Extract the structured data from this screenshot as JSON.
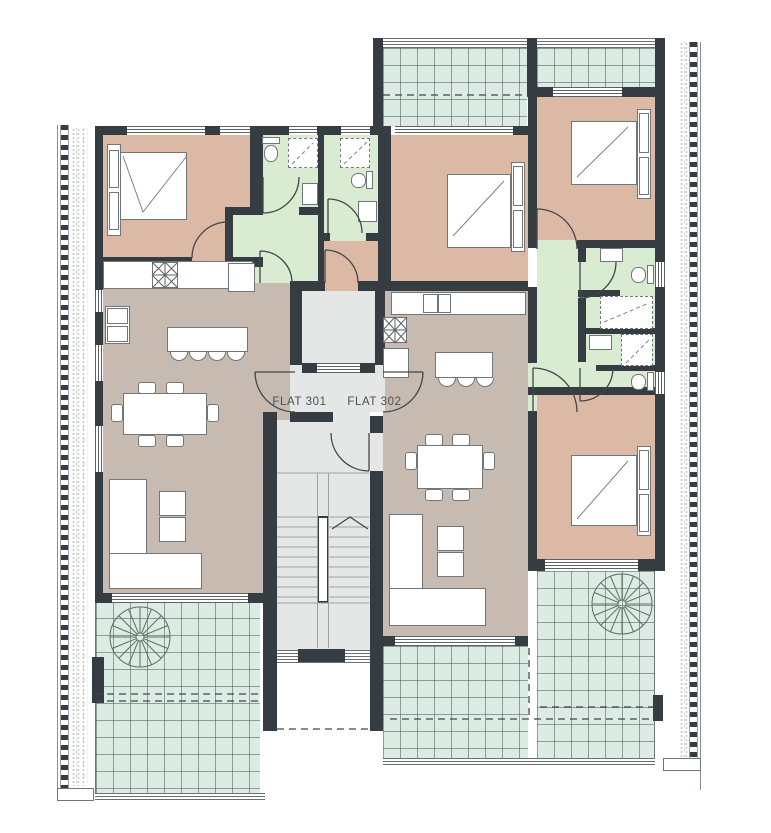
{
  "labels": {
    "flat301": "FLAT 301",
    "flat302": "FLAT 302"
  },
  "palette": {
    "paper": "#ffffff",
    "wall": "#353c42",
    "bedroom": "#dcb9a5",
    "living": "#c7bbb1",
    "bath": "#d9ecd2",
    "tile": "#dcebe4",
    "stair": "#e5e7e6",
    "text": "#4b5055"
  }
}
